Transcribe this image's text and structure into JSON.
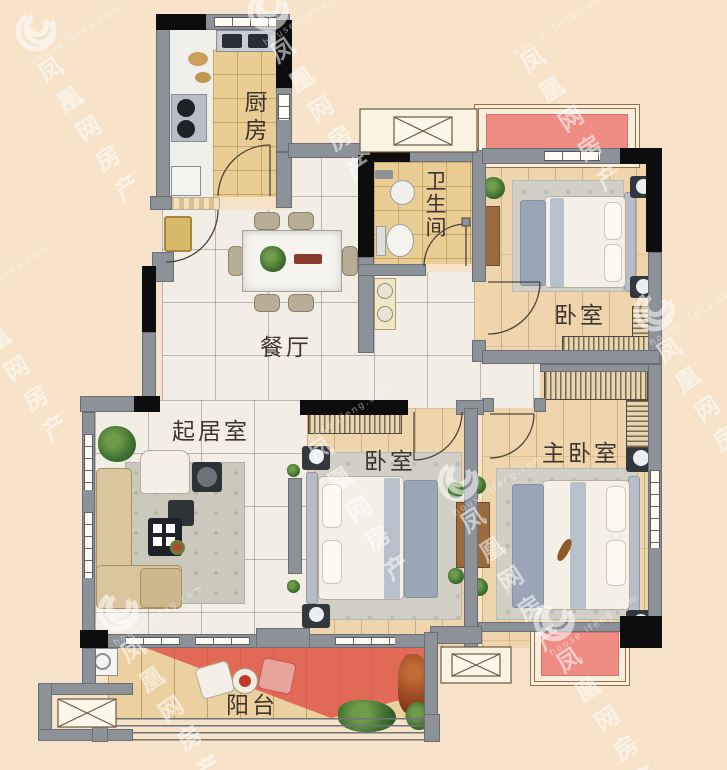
{
  "plan": {
    "type": "apartment-floor-plan",
    "rooms": {
      "kitchen": {
        "label": "厨房"
      },
      "bathroom": {
        "label": "卫生间"
      },
      "bedroom_top": {
        "label": "卧室"
      },
      "dining": {
        "label": "餐厅"
      },
      "living": {
        "label": "起居室"
      },
      "bedroom_mid": {
        "label": "卧室"
      },
      "master_bedroom": {
        "label": "主卧室"
      },
      "balcony": {
        "label": "阳台"
      }
    }
  },
  "watermark": {
    "brand": "凤凰网房产",
    "site": "house.ifeng.com"
  },
  "colors": {
    "background": "#f6e3c9",
    "wall_gray": "#8d9198",
    "wall_black": "#0d0d0d",
    "platform_pink": "#ef8c84",
    "balcony_red": "#e04b42",
    "tile_tan": "#e9cd94",
    "marble": "#f2eee6",
    "wood": "#eed5ae"
  }
}
